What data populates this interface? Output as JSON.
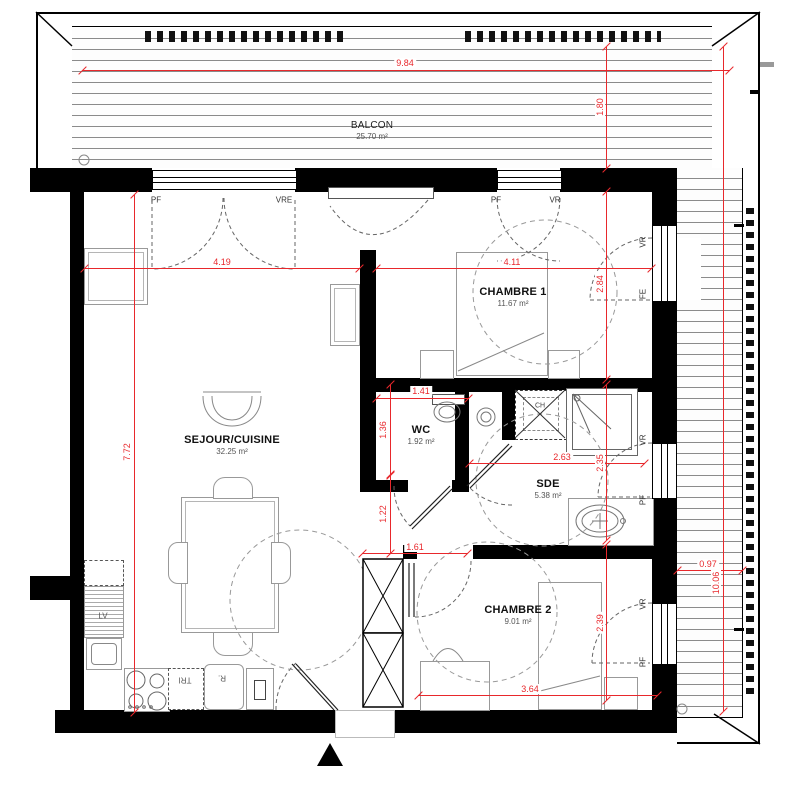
{
  "colors": {
    "dimension_red": "#e8282c",
    "wall_black": "#000000",
    "furniture_gray": "#999999"
  },
  "rooms": {
    "balcon": {
      "name": "BALCON",
      "area": "25.70 m²"
    },
    "sejour": {
      "name": "SEJOUR/CUISINE",
      "area": "32.25 m²"
    },
    "chambre1": {
      "name": "CHAMBRE 1",
      "area": "11.67 m²"
    },
    "wc": {
      "name": "WC",
      "area": "1.92 m²"
    },
    "sde": {
      "name": "SDE",
      "area": "5.38 m²"
    },
    "chambre2": {
      "name": "CHAMBRE 2",
      "area": "9.01 m²"
    }
  },
  "dimensions": {
    "balcon_width": "9.84",
    "balcon_depth": "1.80",
    "sejour_width": "4.19",
    "chambre1_width": "4.11",
    "chambre1_depth": "2.84",
    "sejour_height": "7.72",
    "wc_width": "1.41",
    "wc_depth": "1.36",
    "sde_width": "2.63",
    "sde_depth": "2.35",
    "hall_height": "1.22",
    "hall_width": "1.61",
    "chambre2_depth": "2.39",
    "chambre2_width": "3.64",
    "balcon_east_width": "0.97",
    "balcon_east_height": "10.06"
  },
  "openings": {
    "bay_window_left": {
      "left": "PF",
      "right": "VRE"
    },
    "bay_window_mid": {
      "left": "PF",
      "right": "VR"
    },
    "chambre1_window": {
      "top": "VR",
      "bottom": "FE"
    },
    "sde_window": {
      "top": "VR",
      "bottom": "PF"
    },
    "chambre2_window": {
      "top": "VR",
      "bottom": "PF"
    }
  },
  "appliances": {
    "dishwasher": "LV",
    "water_heater": "CH",
    "fridge": "R.",
    "waste_sorting": "TRI"
  }
}
